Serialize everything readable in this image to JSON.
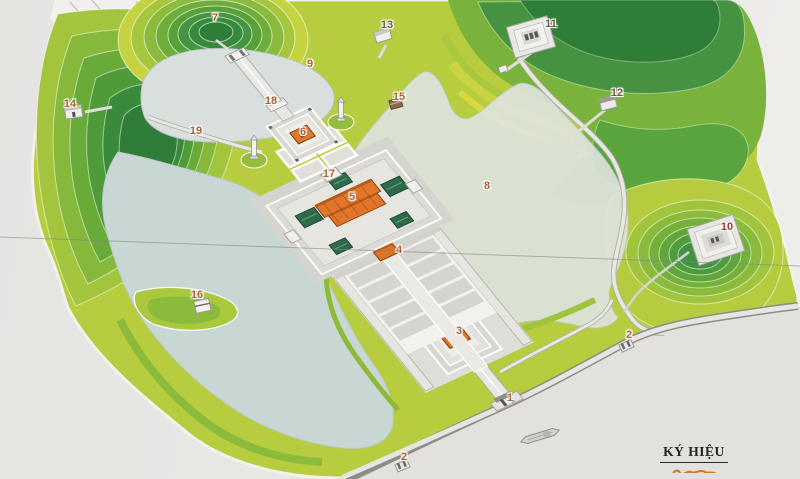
{
  "map": {
    "kind": "site-model-photo",
    "legend": {
      "title": "KÝ HIỆU"
    },
    "markers": [
      {
        "label": "7",
        "x": 215,
        "y": 18,
        "tone": "default"
      },
      {
        "label": "13",
        "x": 387,
        "y": 25,
        "tone": "dark"
      },
      {
        "label": "11",
        "x": 551,
        "y": 24,
        "tone": "dark"
      },
      {
        "label": "9",
        "x": 310,
        "y": 64,
        "tone": "default"
      },
      {
        "label": "12",
        "x": 617,
        "y": 93,
        "tone": "dark"
      },
      {
        "label": "15",
        "x": 399,
        "y": 97,
        "tone": "default"
      },
      {
        "label": "18",
        "x": 271,
        "y": 101,
        "tone": "default"
      },
      {
        "label": "14",
        "x": 70,
        "y": 104,
        "tone": "default"
      },
      {
        "label": "19",
        "x": 196,
        "y": 131,
        "tone": "default"
      },
      {
        "label": "6",
        "x": 303,
        "y": 132,
        "tone": "default"
      },
      {
        "label": "17",
        "x": 329,
        "y": 174,
        "tone": "default"
      },
      {
        "label": "8",
        "x": 487,
        "y": 186,
        "tone": "default"
      },
      {
        "label": "5",
        "x": 352,
        "y": 197,
        "tone": "default"
      },
      {
        "label": "10",
        "x": 727,
        "y": 227,
        "tone": "red"
      },
      {
        "label": "4",
        "x": 399,
        "y": 250,
        "tone": "default"
      },
      {
        "label": "16",
        "x": 197,
        "y": 295,
        "tone": "default"
      },
      {
        "label": "3",
        "x": 459,
        "y": 331,
        "tone": "default"
      },
      {
        "label": "2",
        "x": 629,
        "y": 335,
        "tone": "default"
      },
      {
        "label": "1",
        "x": 510,
        "y": 398,
        "tone": "default"
      },
      {
        "label": "2",
        "x": 404,
        "y": 457,
        "tone": "default"
      }
    ],
    "colors": {
      "background": "#e9e8e5",
      "water": "#ccd8d5",
      "land_light": "#b7cc3f",
      "land_dark": "#35883c",
      "path": "#e6e5e0",
      "building_orange": "#e07a28",
      "roof_green": "#2e6b4a",
      "label_default": "#a8612f",
      "label_dark": "#6f5a46",
      "label_red": "#9c3a32"
    }
  }
}
